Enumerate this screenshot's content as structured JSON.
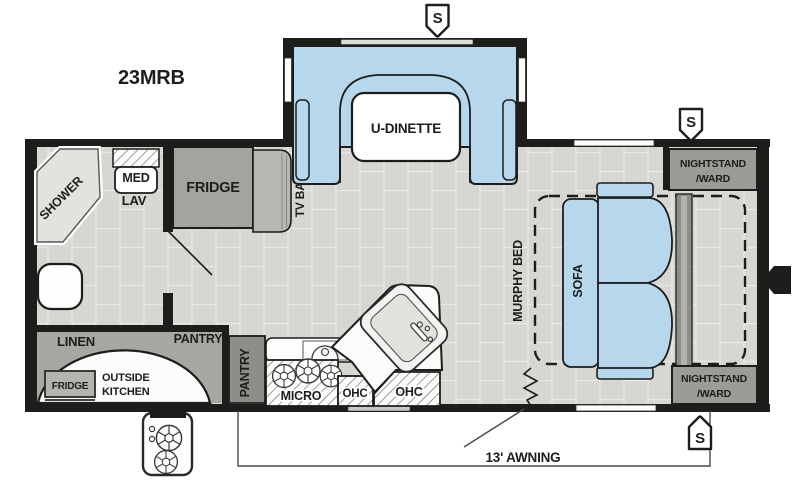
{
  "title": "23MRB",
  "markers": {
    "speaker": "S",
    "hookup": "H"
  },
  "labels": {
    "shower": "SHOWER",
    "med": "MED",
    "lav": "LAV",
    "fridge": "FRIDGE",
    "tv_base": "TV BASE",
    "u_dinette": "U-DINETTE",
    "nightstand_ward_line1": "NIGHTSTAND",
    "nightstand_ward_line2": "/WARD",
    "murphy_bed": "MURPHY BED",
    "sofa": "SOFA",
    "linen": "LINEN",
    "pantry_rear": "PANTRY",
    "pantry_kitchen": "PANTRY",
    "outside_kitchen_line1": "OUTSIDE",
    "outside_kitchen_line2": "KITCHEN",
    "outside_fridge": "FRIDGE",
    "micro": "MICRO",
    "ohc_left": "OHC",
    "ohc_right": "OHC",
    "awning": "13' AWNING"
  },
  "colors": {
    "wall_black": "#1d1d1b",
    "furniture_blue": "#b7d8ec",
    "cabinet_gray": "#9d9b98",
    "floor_tile": "#d8d6d2"
  }
}
